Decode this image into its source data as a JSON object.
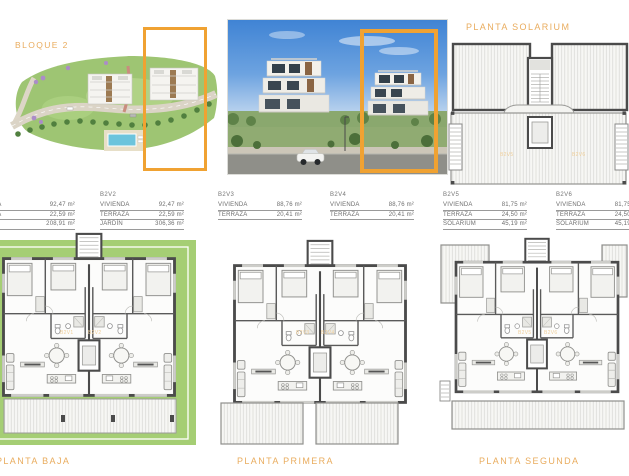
{
  "sheet": {
    "bloque_label": "BLOQUE 2",
    "solarium_title": "PLANTA SOLARIUM"
  },
  "colors": {
    "highlight_orange": "#F0A232",
    "heading_orange": "#E9AC5E",
    "garden_green": "#A5CE74"
  },
  "unit_tables": [
    {
      "id": "B2V1",
      "rows": [
        {
          "label": "VIVIENDA",
          "value": "92,47 m²"
        },
        {
          "label": "TERRAZA",
          "value": "22,59 m²"
        },
        {
          "label": "JARDÍN",
          "value": "208,91 m²"
        }
      ]
    },
    {
      "id": "B2V2",
      "rows": [
        {
          "label": "VIVIENDA",
          "value": "92,47 m²"
        },
        {
          "label": "TERRAZA",
          "value": "22,59 m²"
        },
        {
          "label": "JARDÍN",
          "value": "306,36 m²"
        }
      ]
    },
    {
      "id": "B2V3",
      "rows": [
        {
          "label": "VIVIENDA",
          "value": "88,76 m²"
        },
        {
          "label": "TERRAZA",
          "value": "20,41 m²"
        }
      ]
    },
    {
      "id": "B2V4",
      "rows": [
        {
          "label": "VIVIENDA",
          "value": "88,76 m²"
        },
        {
          "label": "TERRAZA",
          "value": "20,41 m²"
        }
      ]
    },
    {
      "id": "B2V5",
      "rows": [
        {
          "label": "VIVIENDA",
          "value": "81,75 m²"
        },
        {
          "label": "TERRAZA",
          "value": "24,50 m²"
        },
        {
          "label": "SOLARIUM",
          "value": "45,19 m²"
        }
      ]
    },
    {
      "id": "B2V6",
      "rows": [
        {
          "label": "VIVIENDA",
          "value": "81,75 m²"
        },
        {
          "label": "TERRAZA",
          "value": "24,50 m²"
        },
        {
          "label": "SOLARIUM",
          "value": "45,19 m²"
        }
      ]
    }
  ],
  "plans": {
    "baja": {
      "title": "PLANTA BAJA"
    },
    "primera": {
      "title": "PLANTA PRIMERA"
    },
    "segunda": {
      "title": "PLANTA SEGUNDA"
    }
  },
  "plan_labels": {
    "baja": [
      "B2V1",
      "B2V2"
    ],
    "primera": [
      "B2V3",
      "B2V4"
    ],
    "segunda": [
      "B2V5",
      "B2V6"
    ],
    "solarium": [
      "B2V5",
      "B2V6"
    ]
  }
}
